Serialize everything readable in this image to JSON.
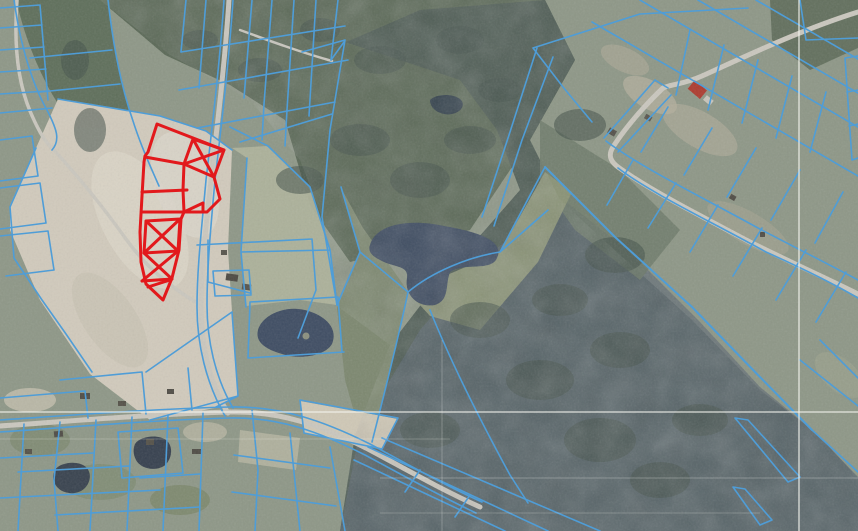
{
  "map": {
    "type": "cadastral-aerial-viewer",
    "layers": [
      {
        "name": "orthophoto-imagery"
      },
      {
        "name": "cadastral-parcel-boundaries"
      },
      {
        "name": "selected-parcels-highlight"
      },
      {
        "name": "coordinate-grid"
      }
    ]
  },
  "colors": {
    "parcel_line": "#4f9dd7",
    "selection_red": "#e2191c",
    "grid_line": "#f4f4ef",
    "field_tan": "#d1cabc",
    "field_light": "#ddd7c9",
    "forest_green": "#4e5c54",
    "forest_slate": "#5b6775",
    "scrub_dark": "#5b6957",
    "scrub_mid": "#6e7a6a",
    "grass_base": "#8e9787",
    "pasture": "#aeb29b",
    "clearing": "#7d8870",
    "pond": "#3e4c61",
    "road": "#cac7be",
    "building": "#4d4a43",
    "roof_red": "#ad3c30"
  }
}
